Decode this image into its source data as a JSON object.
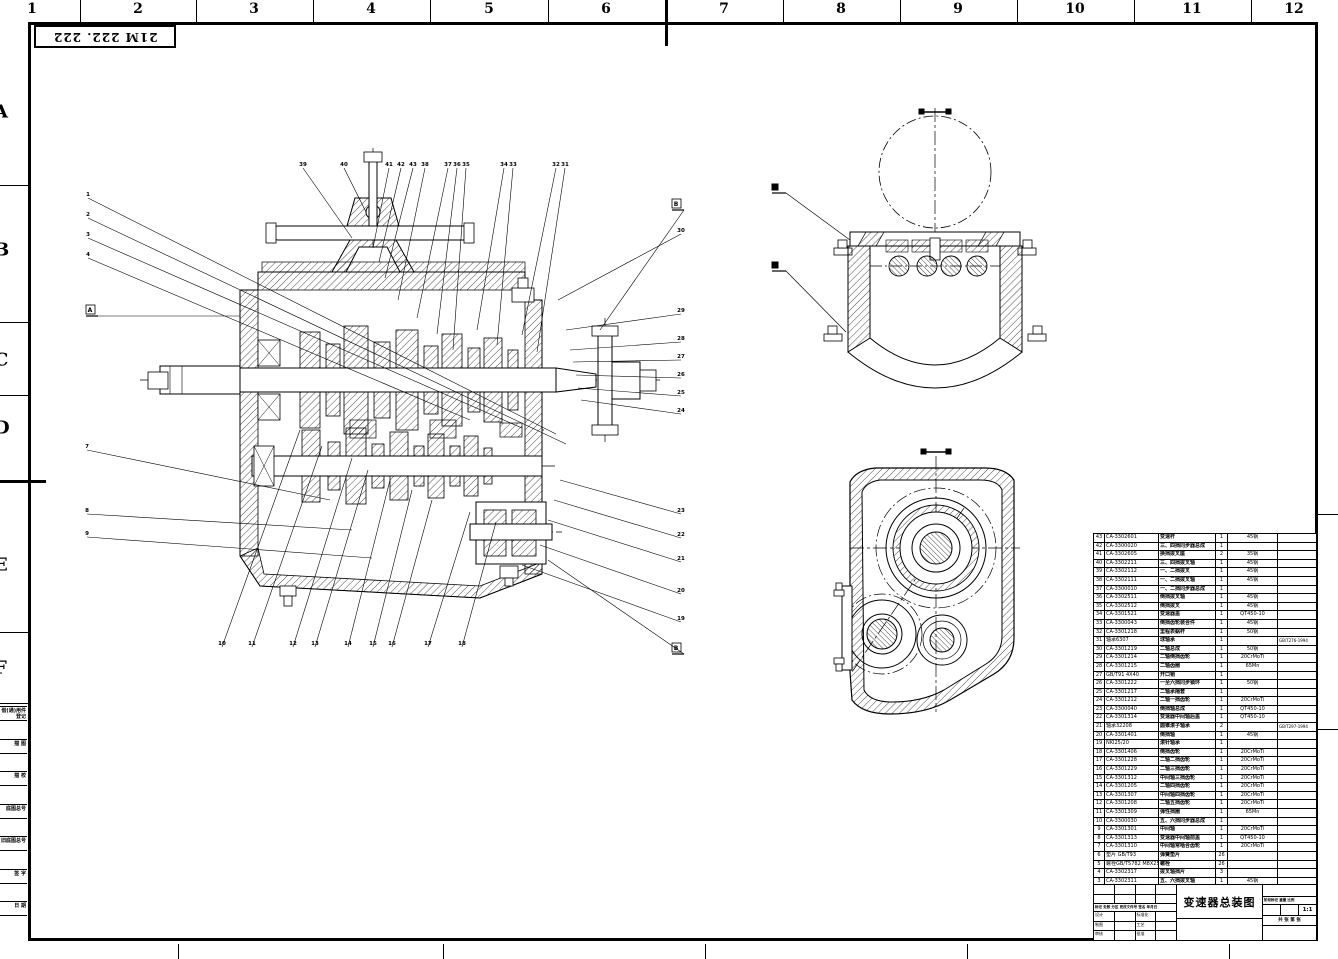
{
  "sheet": {
    "stamp": "21M 222. 222",
    "top_grid": [
      "1",
      "2",
      "3",
      "4",
      "5",
      "6",
      "7",
      "8",
      "9",
      "10",
      "11",
      "12"
    ],
    "left_grid": [
      "A",
      "B",
      "C",
      "D",
      "E",
      "F"
    ],
    "margin_boxes": [
      "借(通)用件登记",
      "描 图",
      "描 校",
      "底图总号",
      "旧底图总号",
      "签 字",
      "日 期"
    ]
  },
  "parts_table": {
    "headers": [
      "序号",
      "代号",
      "名称",
      "数量",
      "材料",
      "备注"
    ],
    "rows": [
      [
        "43",
        "CA-3302601",
        "变速杆",
        "1",
        "45钢",
        ""
      ],
      [
        "42",
        "CA-3300020",
        "三、四挡同步器总成",
        "1",
        "",
        ""
      ],
      [
        "41",
        "CA-3302605",
        "换挡拨叉座",
        "2",
        "35钢",
        ""
      ],
      [
        "40",
        "CA-3302211",
        "三、四挡拨叉轴",
        "1",
        "45钢",
        ""
      ],
      [
        "39",
        "CA-3302112",
        "一、二挡拨叉",
        "1",
        "45钢",
        ""
      ],
      [
        "38",
        "CA-3302111",
        "一、二挡拨叉轴",
        "1",
        "45钢",
        ""
      ],
      [
        "37",
        "CA-3300010",
        "一、二挡同步器总成",
        "1",
        "",
        ""
      ],
      [
        "36",
        "CA-3302511",
        "倒挡拨叉轴",
        "1",
        "45钢",
        ""
      ],
      [
        "35",
        "CA-3302512",
        "倒挡拨叉",
        "1",
        "45钢",
        ""
      ],
      [
        "34",
        "CA-3301521",
        "变速器盖",
        "1",
        "QT450-10",
        ""
      ],
      [
        "33",
        "CA-3300043",
        "倒挡齿轮装合件",
        "1",
        "45钢",
        ""
      ],
      [
        "32",
        "CA-3301218",
        "里程表蜗杆",
        "1",
        "50钢",
        ""
      ],
      [
        "31",
        "轴承6307",
        "球轴承",
        "1",
        "",
        "GB/T276-1994"
      ],
      [
        "30",
        "CA-3301219",
        "二轴总成",
        "1",
        "50钢",
        ""
      ],
      [
        "29",
        "CA-3301214",
        "二轴倒挡齿轮",
        "1",
        "20CrMoTi",
        ""
      ],
      [
        "28",
        "CA-3301215",
        "二轴齿圈",
        "1",
        "65Mn",
        ""
      ],
      [
        "27",
        "GB/T91 4X40",
        "开口销",
        "1",
        "",
        ""
      ],
      [
        "26",
        "CA-3301222",
        "一至六挡同步锁环",
        "1",
        "50钢",
        ""
      ],
      [
        "25",
        "CA-3301217",
        "二轴承隔套",
        "1",
        "",
        ""
      ],
      [
        "24",
        "CA-3301212",
        "二轴一挡齿轮",
        "1",
        "20CrMoTi",
        ""
      ],
      [
        "23",
        "CA-3300040",
        "倒挡轴总成",
        "1",
        "QT450-10",
        ""
      ],
      [
        "22",
        "CA-3301314",
        "变速器中间轴后盖",
        "1",
        "QT450-10",
        ""
      ],
      [
        "21",
        "轴承32208",
        "圆锥滚子轴承",
        "2",
        "",
        "GB/T297-1994"
      ],
      [
        "20",
        "CA-3301401",
        "倒挡轴",
        "1",
        "45钢",
        ""
      ],
      [
        "19",
        "NKI25/20",
        "滚针轴承",
        "1",
        "",
        ""
      ],
      [
        "18",
        "CA-3301406",
        "倒挡齿轮",
        "1",
        "20CrMoTi",
        ""
      ],
      [
        "17",
        "CA-3301228",
        "二轴二挡齿轮",
        "1",
        "20CrMoTi",
        ""
      ],
      [
        "16",
        "CA-3301229",
        "二轴三挡齿轮",
        "1",
        "20CrMoTi",
        ""
      ],
      [
        "15",
        "CA-3301312",
        "中间轴三挡齿轮",
        "1",
        "20CrMoTi",
        ""
      ],
      [
        "14",
        "CA-3301205",
        "二轴四挡齿轮",
        "1",
        "20CrMoTi",
        ""
      ],
      [
        "13",
        "CA-3301307",
        "中间轴四挡齿轮",
        "1",
        "20CrMoTi",
        ""
      ],
      [
        "12",
        "CA-3301208",
        "二轴五挡齿轮",
        "1",
        "20CrMoTi",
        ""
      ],
      [
        "11",
        "CA-3301309",
        "弹性挡圈",
        "1",
        "65Mn",
        ""
      ],
      [
        "10",
        "CA-3300030",
        "五、六挡同步器总成",
        "1",
        "",
        ""
      ],
      [
        "9",
        "CA-3301301",
        "中间轴",
        "1",
        "20CrMoTi",
        ""
      ],
      [
        "8",
        "CA-3301313",
        "变速器中间轴前盖",
        "1",
        "QT450-10",
        ""
      ],
      [
        "7",
        "CA-3301310",
        "中间轴常啮合齿轮",
        "1",
        "20CrMoTi",
        ""
      ],
      [
        "6",
        "垫片 GB/T93",
        "弹簧垫片",
        "26",
        "",
        ""
      ],
      [
        "5",
        "螺栓GB/T5782 M8X25",
        "螺栓",
        "26",
        "",
        ""
      ],
      [
        "4",
        "CA-3302317",
        "拨叉轴挡片",
        "3",
        "",
        ""
      ],
      [
        "3",
        "CA-3302311",
        "五、六挡拨叉轴",
        "1",
        "45钢",
        ""
      ],
      [
        "2",
        "CA-3302312",
        "五、六挡拨叉",
        "1",
        "45钢",
        ""
      ],
      [
        "1",
        "CA-3301521",
        "变速器壳",
        "1",
        "QT450-10",
        ""
      ]
    ]
  },
  "title_block": {
    "title": "变速器总装图",
    "rev_header": "标记 处数 分区 更改文件号 签名 年月日",
    "sign_rows": [
      [
        "设计",
        "标准化"
      ],
      [
        "制图",
        "工艺"
      ],
      [
        "审核",
        "批准"
      ]
    ],
    "stage_header": "阶段标记  重量  比例",
    "stage_vals": [
      "",
      "",
      "1:1"
    ],
    "sheet_row": "共 张  第 张"
  },
  "drawing": {
    "balloons": [
      [
        "1",
        88,
        196,
        556,
        434
      ],
      [
        "2",
        88,
        216,
        566,
        444
      ],
      [
        "3",
        88,
        236,
        522,
        428
      ],
      [
        "4",
        88,
        256,
        470,
        420
      ],
      [
        "7",
        87,
        448,
        330,
        500
      ],
      [
        "8",
        87,
        512,
        352,
        530
      ],
      [
        "9",
        87,
        535,
        372,
        558
      ],
      [
        "10",
        222,
        645,
        300,
        430
      ],
      [
        "11",
        252,
        645,
        322,
        446
      ],
      [
        "12",
        293,
        645,
        352,
        458
      ],
      [
        "13",
        315,
        645,
        368,
        470
      ],
      [
        "14",
        348,
        645,
        390,
        480
      ],
      [
        "15",
        373,
        645,
        412,
        490
      ],
      [
        "16",
        392,
        645,
        432,
        500
      ],
      [
        "17",
        428,
        645,
        470,
        512
      ],
      [
        "18",
        462,
        645,
        496,
        522
      ],
      [
        "39",
        303,
        166,
        352,
        238
      ],
      [
        "40",
        344,
        166,
        366,
        212
      ],
      [
        "41",
        389,
        166,
        373,
        248
      ],
      [
        "42",
        401,
        166,
        379,
        262
      ],
      [
        "43",
        413,
        166,
        385,
        278
      ],
      [
        "38",
        425,
        166,
        398,
        300
      ],
      [
        "37",
        448,
        166,
        417,
        318
      ],
      [
        "36",
        457,
        166,
        437,
        334
      ],
      [
        "35",
        466,
        166,
        453,
        350
      ],
      [
        "34",
        504,
        166,
        477,
        330
      ],
      [
        "33",
        513,
        166,
        497,
        345
      ],
      [
        "32",
        556,
        166,
        522,
        335
      ],
      [
        "31",
        565,
        166,
        537,
        352
      ],
      [
        "30",
        681,
        232,
        558,
        300
      ],
      [
        "29",
        681,
        312,
        566,
        330
      ],
      [
        "28",
        681,
        340,
        570,
        350
      ],
      [
        "27",
        681,
        358,
        573,
        362
      ],
      [
        "26",
        681,
        376,
        576,
        375
      ],
      [
        "25",
        681,
        394,
        578,
        388
      ],
      [
        "24",
        681,
        412,
        581,
        400
      ],
      [
        "23",
        681,
        512,
        560,
        480
      ],
      [
        "22",
        681,
        536,
        554,
        500
      ],
      [
        "21",
        681,
        560,
        548,
        520
      ],
      [
        "20",
        681,
        592,
        540,
        545
      ],
      [
        "19",
        681,
        620,
        522,
        565
      ]
    ],
    "section_markers": [
      [
        "A",
        90,
        310,
        240,
        316
      ],
      [
        "B",
        676,
        204,
        600,
        330
      ],
      [
        "B",
        676,
        648,
        548,
        560
      ]
    ]
  }
}
